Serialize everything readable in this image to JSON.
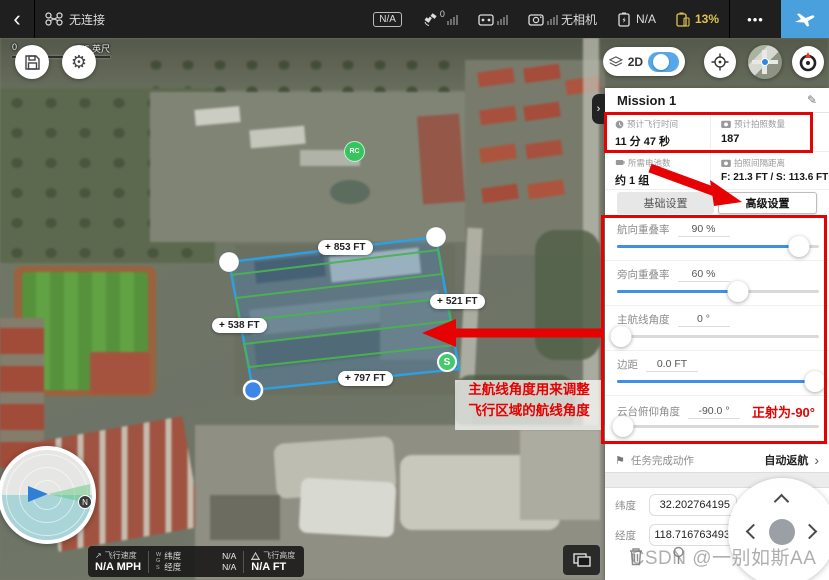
{
  "colors": {
    "accent_blue": "#4aa0dc",
    "slider_blue": "#3d8fe8",
    "battery_yellow": "#dec549",
    "annotation_red": "#e60000",
    "polygon_blue": "#2e9fe0",
    "scanline_green": "#49b34f"
  },
  "icons": {
    "back": "‹",
    "plus": "+",
    "edit": "✎",
    "flag": "⚑",
    "chevron_right": "›",
    "more": "•••",
    "speed_arrow": "↗"
  },
  "top_bar": {
    "aircraft_status": "无连接",
    "na_badge": "N/A",
    "satellite_count": "0",
    "camera_status": "无相机",
    "rc_battery": "N/A",
    "battery_percent": "13%"
  },
  "map": {
    "toggle_2d_label": "2D",
    "scale_zero": "0",
    "scale_label": "375 英尺",
    "rc_marker": "RC",
    "start_marker": "S",
    "compass_north": "N",
    "edge_labels": {
      "top": "853 FT",
      "right": "521 FT",
      "left": "538 FT",
      "bottom": "797 FT"
    }
  },
  "annotations": {
    "note_line1": "主航线角度用来调整",
    "note_line2": "飞行区域的航线角度",
    "gimbal_note": "正射为-90°",
    "watermark": "CSDN @一别如斯AA"
  },
  "panel": {
    "title": "Mission 1",
    "stats": [
      {
        "label": "预计飞行时间",
        "value": "11 分 47 秒"
      },
      {
        "label": "预计拍照数量",
        "value": "187"
      },
      {
        "label": "所需电池数",
        "value": "约 1 组"
      },
      {
        "label": "拍照间隔距离",
        "value": "F: 21.3 FT / S: 113.6 FT"
      }
    ],
    "tabs": [
      {
        "label": "基础设置"
      },
      {
        "label": "高级设置"
      }
    ],
    "sliders": [
      {
        "label": "航向重叠率",
        "value": "90 %",
        "percent": 90,
        "fill": 90
      },
      {
        "label": "旁向重叠率",
        "value": "60 %",
        "percent": 60,
        "fill": 60
      },
      {
        "label": "主航线角度",
        "value": "0 °",
        "percent": 2,
        "fill": 2
      },
      {
        "label": "边距",
        "value": "0.0 FT",
        "percent": 98,
        "fill": 98
      },
      {
        "label": "云台俯仰角度",
        "value": "-90.0 °",
        "percent": 3,
        "fill": 0
      }
    ],
    "finish_action": {
      "label": "任务完成动作",
      "value": "自动返航"
    },
    "coords": [
      {
        "label": "纬度",
        "value": "32.202764195"
      },
      {
        "label": "经度",
        "value": "118.716763493"
      }
    ]
  },
  "telemetry": {
    "speed_label": "飞行速度",
    "speed_value": "N/A MPH",
    "wgs": [
      "W",
      "G",
      "S"
    ],
    "lat_label": "纬度",
    "lat_value": "N/A",
    "lng_label": "经度",
    "lng_value": "N/A",
    "alt_label": "飞行高度",
    "alt_value": "N/A FT"
  }
}
